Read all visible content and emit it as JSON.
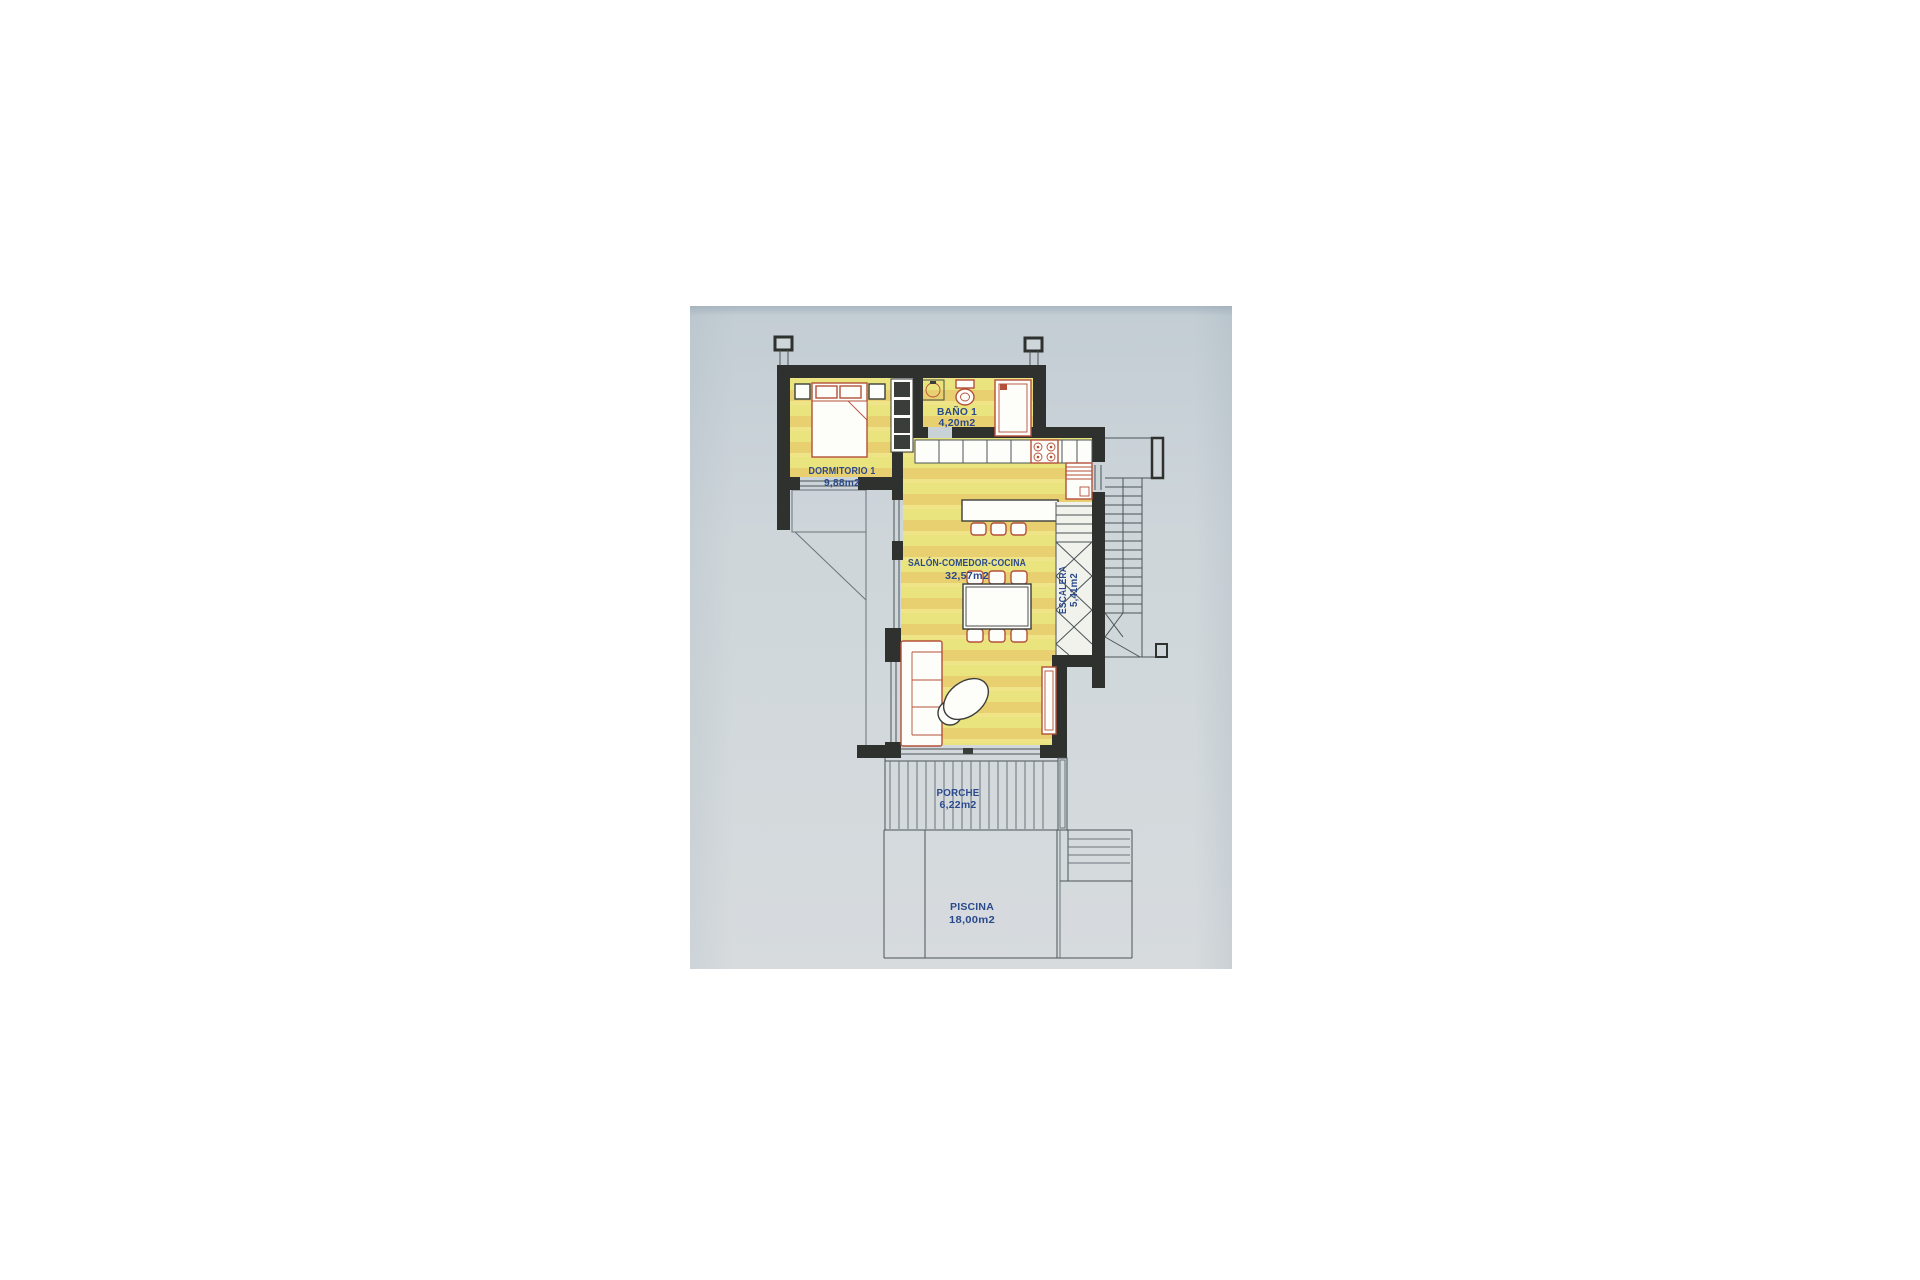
{
  "palette": {
    "page_background": "#ffffff",
    "paper": "#ced6da",
    "wall": "#2e312d",
    "room_fill": "#eae47f",
    "room_stripe": "#e7c96c",
    "furniture_red": "#b5503a",
    "label_blue": "#2b4a8b",
    "line_gray": "#4b5457"
  },
  "plan": {
    "rooms": [
      {
        "name": "DORMITORIO 1",
        "area": "9,88m2"
      },
      {
        "name": "BAÑO 1",
        "area": "4,20m2"
      },
      {
        "name": "SALÓN-COMEDOR-COCINA",
        "area": "32,57m2"
      },
      {
        "name": "ESCALERA",
        "area": "5,41m2"
      },
      {
        "name": "PORCHE",
        "area": "6,22m2"
      },
      {
        "name": "PISCINA",
        "area": "18,00m2"
      }
    ]
  }
}
